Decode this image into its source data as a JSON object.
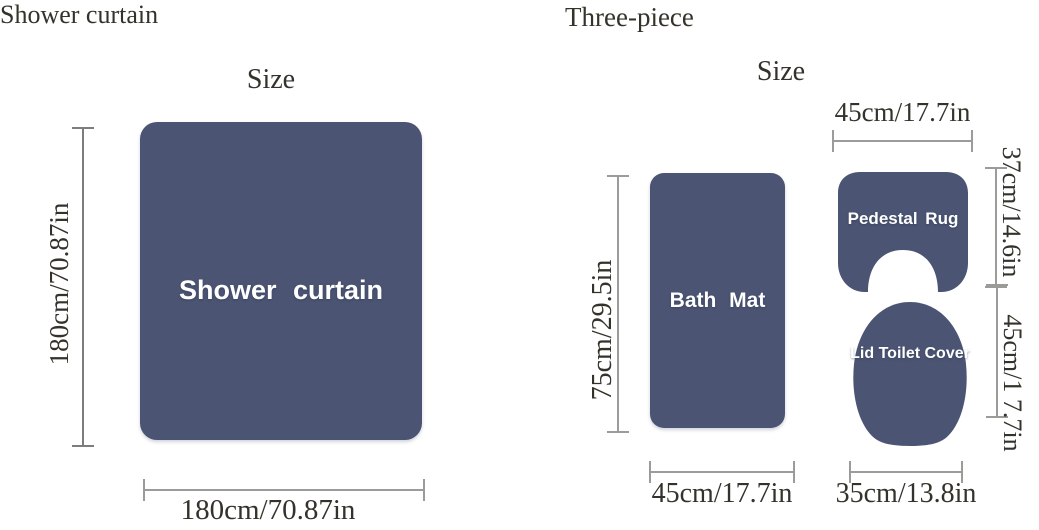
{
  "colors": {
    "shape_fill": "#4b5472",
    "shape_label": "#ffffff",
    "dim_line": "#9b9b98",
    "dim_line_dark": "#7d7d7a",
    "ink": "#34332b",
    "bg": "#ffffff"
  },
  "shower_curtain_panel": {
    "title": "Shower curtain",
    "size_heading": "Size",
    "shape_label": "Shower curtain",
    "height": "180cm/70.87in",
    "width": "180cm/70.87in"
  },
  "three_piece_panel": {
    "title": "Three-piece",
    "size_heading": "Size",
    "bath_mat": {
      "label": "Bath Mat",
      "height": "75cm/29.5in",
      "width": "45cm/17.7in"
    },
    "pedestal_rug": {
      "label": "Pedestal Rug",
      "width": "45cm/17.7in",
      "height": "37cm/14.6in"
    },
    "lid_toilet_cover": {
      "label": "Lid Toilet Cover",
      "height": "45cm/1 7.7in",
      "width": "35cm/13.8in"
    }
  }
}
